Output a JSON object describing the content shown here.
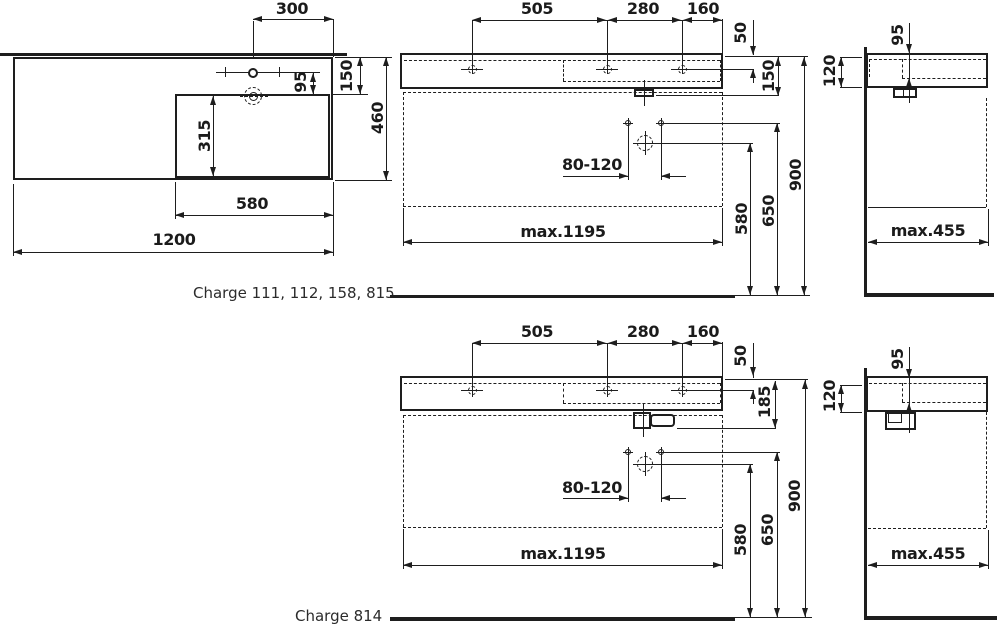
{
  "captions": {
    "top": "Charge 111, 112, 158, 815",
    "bottom": "Charge 814"
  },
  "colors": {
    "line": "#1e1e1e",
    "background": "#ffffff",
    "text": "#1b1b1b"
  },
  "plan_view": {
    "d300": "300",
    "d150": "150",
    "d95": "95",
    "d460": "460",
    "d315": "315",
    "d580": "580",
    "d1200": "1200"
  },
  "front_top": {
    "d505": "505",
    "d280": "280",
    "d160": "160",
    "d50": "50",
    "d150": "150",
    "d80_120": "80-120",
    "dmax_w": "max.1195",
    "d580": "580",
    "d650": "650",
    "d900": "900"
  },
  "side_top": {
    "d95": "95",
    "d120": "120",
    "dmax_d": "max.455"
  },
  "front_bottom": {
    "d505": "505",
    "d280": "280",
    "d160": "160",
    "d50": "50",
    "d185": "185",
    "d80_120": "80-120",
    "dmax_w": "max.1195",
    "d580": "580",
    "d650": "650",
    "d900": "900"
  },
  "side_bottom": {
    "d95": "95",
    "d120": "120",
    "dmax_d": "max.455"
  }
}
